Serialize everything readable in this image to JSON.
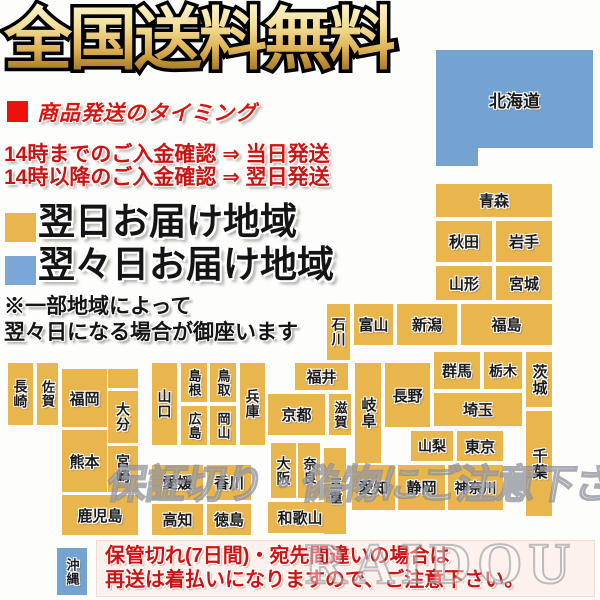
{
  "title": "全国送料無料",
  "shipping": {
    "heading": "商品発送のタイミング",
    "lines": [
      "14時までのご入金確認 ⇒ 当日発送",
      "14時以降のご入金確認 ⇒ 翌日発送"
    ]
  },
  "legend": {
    "next_day": {
      "label": "翌日お届け地域",
      "color": "#e9b54d"
    },
    "two_days": {
      "label": "翌々日お届け地域",
      "color": "#7aa7d5"
    }
  },
  "note": {
    "line1": "※一部地域によって",
    "line2": "翌々日になる場合が御座います"
  },
  "bottom_notice": {
    "line1": "保管切れ(7日間)・宛先間違いの場合は",
    "line2": "再送は着払いになりますので、ご注意下さい。"
  },
  "watermarks": {
    "caution": "保証切り・偽物にご注意下さい",
    "brand": "RAIDOU"
  },
  "colors": {
    "accent_red": "#cc1414",
    "bullet_red": "#ee0f0f",
    "next_day_yellow": "#e9b54d",
    "two_day_blue": "#74a3d2",
    "title_gold": "#ddb152"
  },
  "map": {
    "blocks": [
      {
        "id": "hokkaido",
        "label": "北海道",
        "x": 436,
        "y": 50,
        "w": 157,
        "h": 98,
        "c": "b",
        "fs": 17
      },
      {
        "id": "hokkaido-tab",
        "label": "",
        "x": 436,
        "y": 148,
        "w": 42,
        "h": 18,
        "c": "b"
      },
      {
        "id": "aomori",
        "label": "青森",
        "x": 436,
        "y": 184,
        "w": 116,
        "h": 33,
        "c": "y"
      },
      {
        "id": "akita",
        "label": "秋田",
        "x": 436,
        "y": 221,
        "w": 56,
        "h": 41,
        "c": "y"
      },
      {
        "id": "iwate",
        "label": "岩手",
        "x": 496,
        "y": 221,
        "w": 56,
        "h": 41,
        "c": "y"
      },
      {
        "id": "yamagata",
        "label": "山形",
        "x": 436,
        "y": 266,
        "w": 56,
        "h": 34,
        "c": "y"
      },
      {
        "id": "miyagi",
        "label": "宮城",
        "x": 496,
        "y": 266,
        "w": 56,
        "h": 34,
        "c": "y"
      },
      {
        "id": "niigata",
        "label": "新潟",
        "x": 397,
        "y": 304,
        "w": 60,
        "h": 41,
        "c": "y"
      },
      {
        "id": "fukushima",
        "label": "福島",
        "x": 461,
        "y": 304,
        "w": 91,
        "h": 41,
        "c": "y"
      },
      {
        "id": "toyama",
        "label": "富山",
        "x": 354,
        "y": 304,
        "w": 39,
        "h": 41,
        "c": "y"
      },
      {
        "id": "ishikawa",
        "label": "石川",
        "x": 327,
        "y": 304,
        "w": 23,
        "h": 56,
        "c": "y",
        "v": 1,
        "fs": 14
      },
      {
        "id": "fukui",
        "label": "福井",
        "x": 295,
        "y": 363,
        "w": 53,
        "h": 27,
        "c": "y"
      },
      {
        "id": "gunma",
        "label": "群馬",
        "x": 434,
        "y": 352,
        "w": 46,
        "h": 37,
        "c": "y"
      },
      {
        "id": "tochigi",
        "label": "栃木",
        "x": 484,
        "y": 352,
        "w": 38,
        "h": 37,
        "c": "y",
        "fs": 14
      },
      {
        "id": "ibaraki",
        "label": "茨城",
        "x": 526,
        "y": 352,
        "w": 26,
        "h": 55,
        "c": "y",
        "v": 1,
        "fs": 15
      },
      {
        "id": "nagano",
        "label": "長野",
        "x": 385,
        "y": 363,
        "w": 45,
        "h": 64,
        "c": "y"
      },
      {
        "id": "gifu",
        "label": "岐阜",
        "x": 355,
        "y": 363,
        "w": 26,
        "h": 100,
        "c": "y",
        "v": 1,
        "fs": 15
      },
      {
        "id": "saitama",
        "label": "埼玉",
        "x": 434,
        "y": 393,
        "w": 88,
        "h": 33,
        "c": "y"
      },
      {
        "id": "yamanashi",
        "label": "山梨",
        "x": 411,
        "y": 431,
        "w": 42,
        "h": 30,
        "c": "y",
        "fs": 14
      },
      {
        "id": "tokyo",
        "label": "東京",
        "x": 457,
        "y": 431,
        "w": 46,
        "h": 30,
        "c": "y"
      },
      {
        "id": "chiba",
        "label": "千葉",
        "x": 526,
        "y": 411,
        "w": 26,
        "h": 105,
        "c": "y",
        "v": 1,
        "fs": 15
      },
      {
        "id": "kanagawa",
        "label": "神奈川",
        "x": 448,
        "y": 465,
        "w": 55,
        "h": 45,
        "c": "y",
        "fs": 14
      },
      {
        "id": "shizuoka",
        "label": "静岡",
        "x": 398,
        "y": 465,
        "w": 47,
        "h": 45,
        "c": "y"
      },
      {
        "id": "aichi",
        "label": "愛知",
        "x": 352,
        "y": 465,
        "w": 43,
        "h": 45,
        "c": "y"
      },
      {
        "id": "mie",
        "label": "三重",
        "x": 324,
        "y": 448,
        "w": 22,
        "h": 86,
        "c": "y",
        "v": 1,
        "fs": 13
      },
      {
        "id": "shiga",
        "label": "滋賀",
        "x": 329,
        "y": 394,
        "w": 22,
        "h": 41,
        "c": "y",
        "v": 1,
        "fs": 13
      },
      {
        "id": "kyoto",
        "label": "京都",
        "x": 268,
        "y": 394,
        "w": 57,
        "h": 41,
        "c": "y"
      },
      {
        "id": "osaka",
        "label": "大阪",
        "x": 271,
        "y": 443,
        "w": 25,
        "h": 55,
        "c": "y",
        "v": 1,
        "fs": 14
      },
      {
        "id": "nara",
        "label": "奈良",
        "x": 298,
        "y": 443,
        "w": 22,
        "h": 55,
        "c": "y",
        "v": 1,
        "fs": 13
      },
      {
        "id": "wakayama",
        "label": "和歌山",
        "x": 268,
        "y": 502,
        "w": 64,
        "h": 31,
        "c": "y",
        "fs": 15
      },
      {
        "id": "hyogo",
        "label": "兵庫",
        "x": 240,
        "y": 363,
        "w": 25,
        "h": 82,
        "c": "y",
        "v": 1,
        "fs": 14
      },
      {
        "id": "tottori",
        "label": "鳥取",
        "x": 210,
        "y": 363,
        "w": 26,
        "h": 39,
        "c": "y",
        "v": 1,
        "fs": 13
      },
      {
        "id": "shimane",
        "label": "島根",
        "x": 181,
        "y": 363,
        "w": 26,
        "h": 39,
        "c": "y",
        "v": 1,
        "fs": 13
      },
      {
        "id": "okayama",
        "label": "岡山",
        "x": 210,
        "y": 406,
        "w": 26,
        "h": 39,
        "c": "y",
        "v": 1,
        "fs": 13
      },
      {
        "id": "hiroshima",
        "label": "広島",
        "x": 181,
        "y": 406,
        "w": 26,
        "h": 39,
        "c": "y",
        "v": 1,
        "fs": 13
      },
      {
        "id": "yamaguchi",
        "label": "山口",
        "x": 152,
        "y": 363,
        "w": 25,
        "h": 82,
        "c": "y",
        "v": 1,
        "fs": 14
      },
      {
        "id": "ehime",
        "label": "愛媛",
        "x": 152,
        "y": 465,
        "w": 51,
        "h": 35,
        "c": "y"
      },
      {
        "id": "kagawa",
        "label": "香川",
        "x": 207,
        "y": 465,
        "w": 44,
        "h": 35,
        "c": "y"
      },
      {
        "id": "kochi",
        "label": "高知",
        "x": 152,
        "y": 504,
        "w": 51,
        "h": 31,
        "c": "y"
      },
      {
        "id": "tokushima",
        "label": "徳島",
        "x": 207,
        "y": 504,
        "w": 44,
        "h": 31,
        "c": "y"
      },
      {
        "id": "nagasaki",
        "label": "長崎",
        "x": 8,
        "y": 363,
        "w": 25,
        "h": 62,
        "c": "y",
        "v": 1,
        "fs": 14
      },
      {
        "id": "saga",
        "label": "佐賀",
        "x": 37,
        "y": 363,
        "w": 21,
        "h": 62,
        "c": "y",
        "v": 1,
        "fs": 13
      },
      {
        "id": "fukuoka",
        "label": "福岡",
        "x": 62,
        "y": 369,
        "w": 45,
        "h": 58,
        "c": "y"
      },
      {
        "id": "fukuoka-ext",
        "label": "",
        "x": 108,
        "y": 369,
        "w": 30,
        "h": 19,
        "c": "y"
      },
      {
        "id": "oita",
        "label": "大分",
        "x": 108,
        "y": 391,
        "w": 30,
        "h": 52,
        "c": "y",
        "v": 1,
        "fs": 14
      },
      {
        "id": "kumamoto",
        "label": "熊本",
        "x": 62,
        "y": 430,
        "w": 45,
        "h": 62,
        "c": "y"
      },
      {
        "id": "miyazaki",
        "label": "宮崎",
        "x": 108,
        "y": 446,
        "w": 30,
        "h": 46,
        "c": "y",
        "v": 1,
        "fs": 14
      },
      {
        "id": "kagoshima",
        "label": "鹿児島",
        "x": 62,
        "y": 495,
        "w": 76,
        "h": 40,
        "c": "y",
        "fs": 15
      },
      {
        "id": "okinawa",
        "label": "沖縄",
        "x": 57,
        "y": 548,
        "w": 30,
        "h": 47,
        "c": "b",
        "v": 1,
        "fs": 13
      }
    ]
  }
}
